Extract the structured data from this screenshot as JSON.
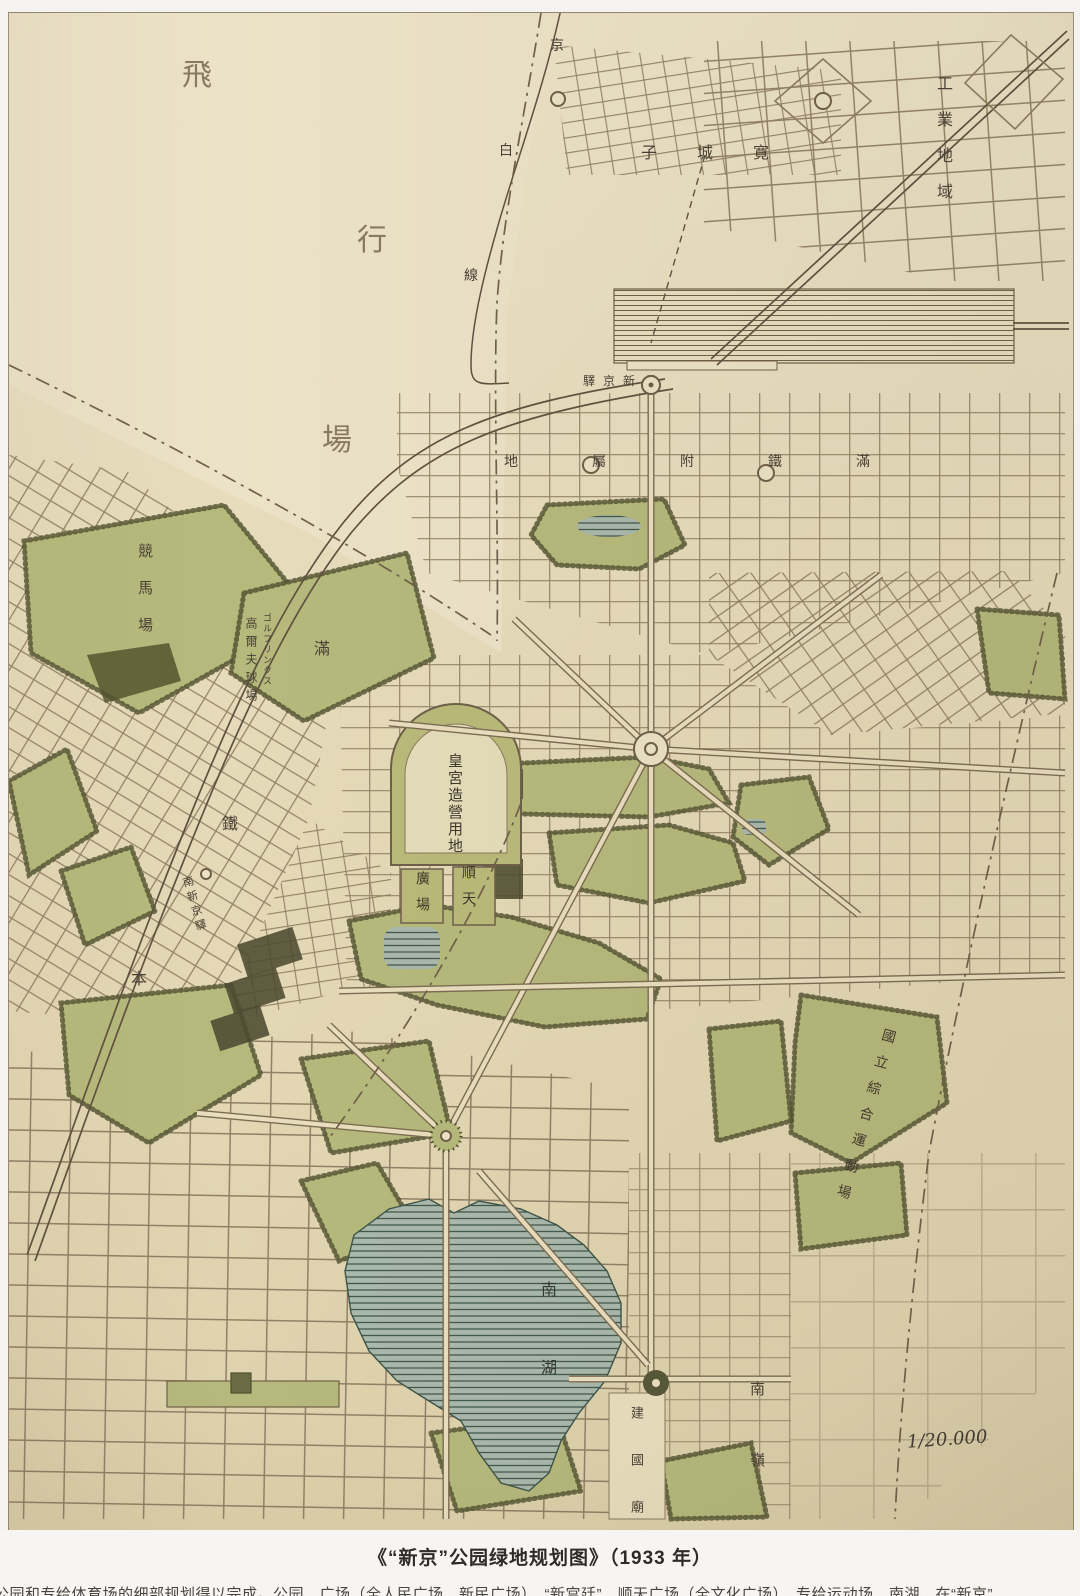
{
  "photo": {
    "background_color": "#f4f3ef",
    "caption": {
      "title": "《“新京”公园绿地规划图》（1933 年）",
      "footnote_partial": "公园和专给体育场的细部规划得以完成。公园、广场（全人民广场、新民广场）、“新宫廷”、顺天广场（全文化广场）、专给运动场、南湖，在“新京”……"
    }
  },
  "map": {
    "scale_label": "1/20.000",
    "colors": {
      "paper": "#e7dcbc",
      "paper_light": "#ece2c7",
      "street_line": "#8d7c60",
      "park_green": "#b6b97c",
      "park_edge": "#50502f",
      "water": "#a9b9ac",
      "water_hatch": "#41584c",
      "rail": "#5f5140",
      "ink": "#4a4136"
    },
    "labels": {
      "airfield": {
        "text": "飛行場",
        "chars": [
          "飛",
          "行",
          "場"
        ]
      },
      "jingbai_rail_line": {
        "text": "京白線",
        "chars": [
          "京",
          "白",
          "線"
        ]
      },
      "kuanchengzi": {
        "text": "寛城子"
      },
      "industrial_area": {
        "text": "工業地域"
      },
      "xinjing_station": {
        "text": "新京驛"
      },
      "smr_railway_zone": {
        "text": "滿鐵附屬地"
      },
      "racecourse": {
        "text": "競馬場"
      },
      "golf_links_cn": {
        "text": "高爾夫球場"
      },
      "golf_links_kana": {
        "text": "ゴルフリンクス"
      },
      "mantetsu_main_line": {
        "text": "滿鐵本線",
        "chars": [
          "滿",
          "鐵",
          "本"
        ]
      },
      "south_xinjing_station": {
        "text": "南新京驛"
      },
      "palace_site": {
        "text": "皇宮造營用地"
      },
      "shuntian_plaza_right": {
        "text": "順天"
      },
      "shuntian_plaza_left": {
        "text": "廣場"
      },
      "national_stadium": {
        "text": "國立綜合運動場"
      },
      "south_lake": {
        "text": "南湖"
      },
      "jianguo_temple": {
        "text": "建國廟"
      },
      "nanling": {
        "text": "南嶺"
      }
    }
  }
}
